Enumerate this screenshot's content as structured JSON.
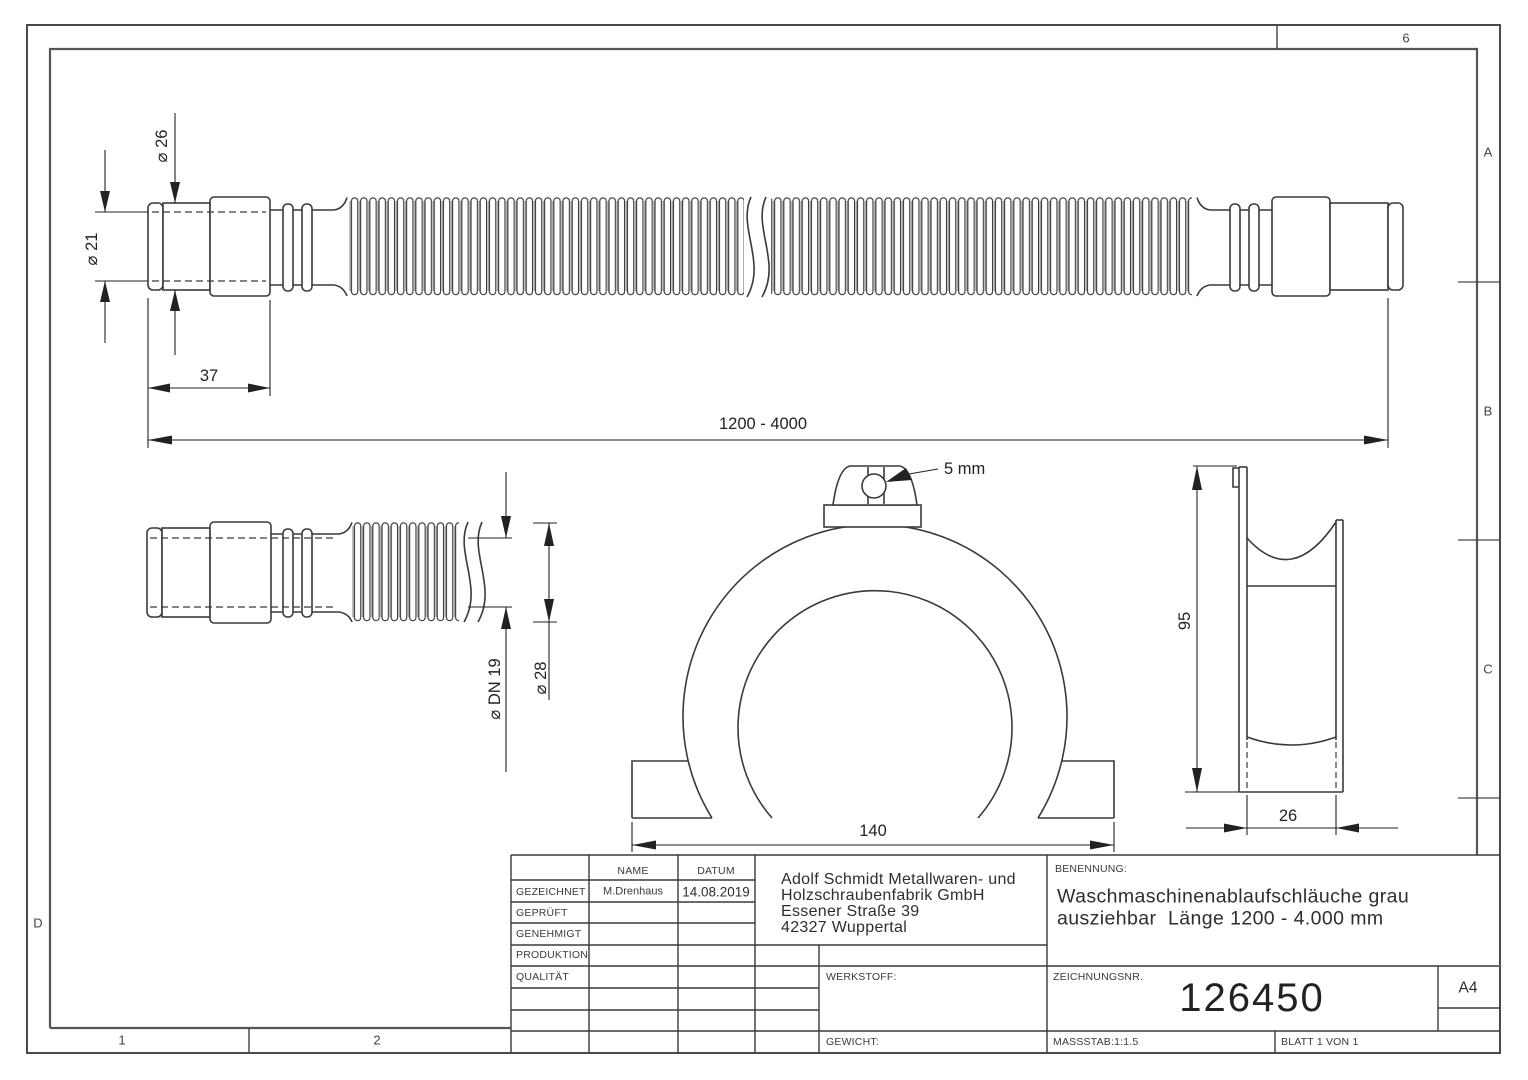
{
  "zones": {
    "top_6": "6",
    "right_a": "A",
    "right_b": "B",
    "right_c": "C",
    "left_d": "D",
    "bottom_1": "1",
    "bottom_2": "2"
  },
  "dimensions": {
    "main_view": {
      "outer_dia": "⌀ 26",
      "inner_dia": "⌀ 21",
      "connector_length": "37",
      "total_length": "1200 - 4000"
    },
    "detail_view": {
      "nominal_dia": "⌀ DN 19",
      "outer_dia": "⌀ 28"
    },
    "bracket_front": {
      "hole": "5 mm",
      "width": "140"
    },
    "bracket_side": {
      "height": "95",
      "depth": "26"
    }
  },
  "title_block": {
    "header": {
      "name": "NAME",
      "datum": "DATUM"
    },
    "rows": [
      {
        "label": "GEZEICHNET",
        "name": "M.Drenhaus",
        "datum": "14.08.2019"
      },
      {
        "label": "GEPRÜFT",
        "name": "",
        "datum": ""
      },
      {
        "label": "GENEHMIGT",
        "name": "",
        "datum": ""
      },
      {
        "label": "PRODUKTION",
        "name": "",
        "datum": ""
      },
      {
        "label": "QUALITÄT",
        "name": "",
        "datum": ""
      }
    ],
    "company": {
      "line1": "Adolf Schmidt Metallwaren- und",
      "line2": "Holzschraubenfabrik GmbH",
      "line3": "Essener Straße 39",
      "line4": "42327 Wuppertal"
    },
    "werkstoff_label": "WERKSTOFF:",
    "gewicht_label": "GEWICHT:",
    "benennung_label": "BENENNUNG:",
    "benennung": {
      "line1": "Waschmaschinenablaufschläuche grau",
      "line2": "ausziehbar  Länge 1200 - 4.000 mm"
    },
    "zeichnungsnr_label": "ZEICHNUNGSNR.",
    "drawing_number": "126450",
    "paper_format": "A4",
    "massstab": "MASSSTAB:1:1.5",
    "blatt": "BLATT 1 VON 1"
  }
}
